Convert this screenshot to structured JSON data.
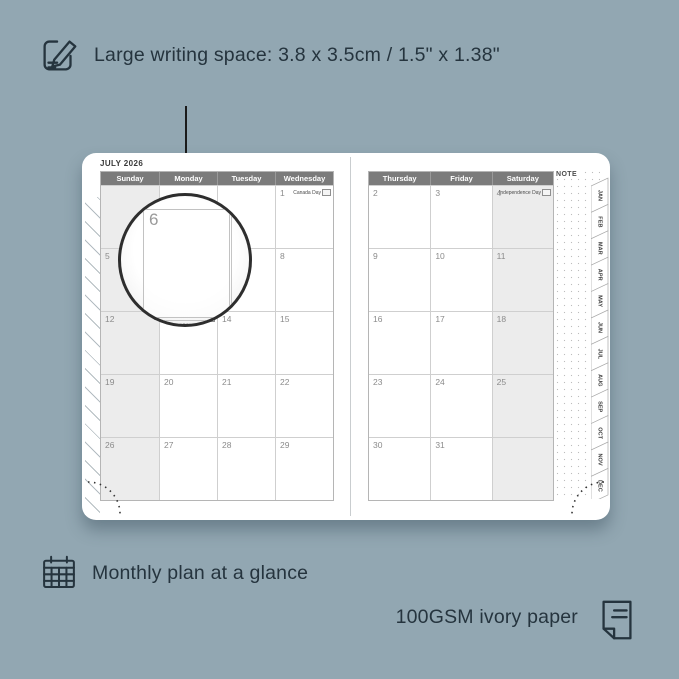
{
  "annotations": {
    "top_text": "Large writing space: 3.8 x 3.5cm / 1.5\" x 1.38\"",
    "bottom_left_text": "Monthly plan at a glance",
    "bottom_right_text": "100GSM ivory paper"
  },
  "calendar": {
    "title": "JULY 2026",
    "note_label": "NOTE",
    "left_weekdays": [
      "Sunday",
      "Monday",
      "Tuesday",
      "Wednesday"
    ],
    "right_weekdays": [
      "Thursday",
      "Friday",
      "Saturday"
    ],
    "left_rows": [
      [
        "",
        "",
        "",
        {
          "d": "1",
          "h": "Canada Day"
        }
      ],
      [
        "5",
        "6",
        "7",
        "8"
      ],
      [
        "12",
        {
          "d": "13",
          "h": "Orangemen's Day (n.i.)"
        },
        "14",
        "15"
      ],
      [
        "19",
        "20",
        "21",
        "22"
      ],
      [
        "26",
        "27",
        "28",
        "29"
      ]
    ],
    "right_rows": [
      [
        "2",
        "3",
        {
          "d": "4",
          "h": "Independence Day"
        }
      ],
      [
        "9",
        "10",
        "11"
      ],
      [
        "16",
        "17",
        "18"
      ],
      [
        "23",
        "24",
        "25"
      ],
      [
        "30",
        "31",
        ""
      ]
    ],
    "month_tabs": [
      "JAN",
      "FEB",
      "MAR",
      "APR",
      "MAY",
      "JUN",
      "JUL",
      "AUG",
      "SEP",
      "OCT",
      "NOV",
      "DEC"
    ]
  },
  "magnifier": {
    "cell_date": "6",
    "adjacent_date": "7",
    "below_date": "13",
    "holiday": "Orangemen's Day",
    "holiday_region": "(n.i.)"
  },
  "colors": {
    "background": "#92a7b2",
    "ink": "#25343e",
    "header_bar": "#7b7b7b",
    "shaded_column": "#ececec",
    "page": "#ffffff"
  }
}
